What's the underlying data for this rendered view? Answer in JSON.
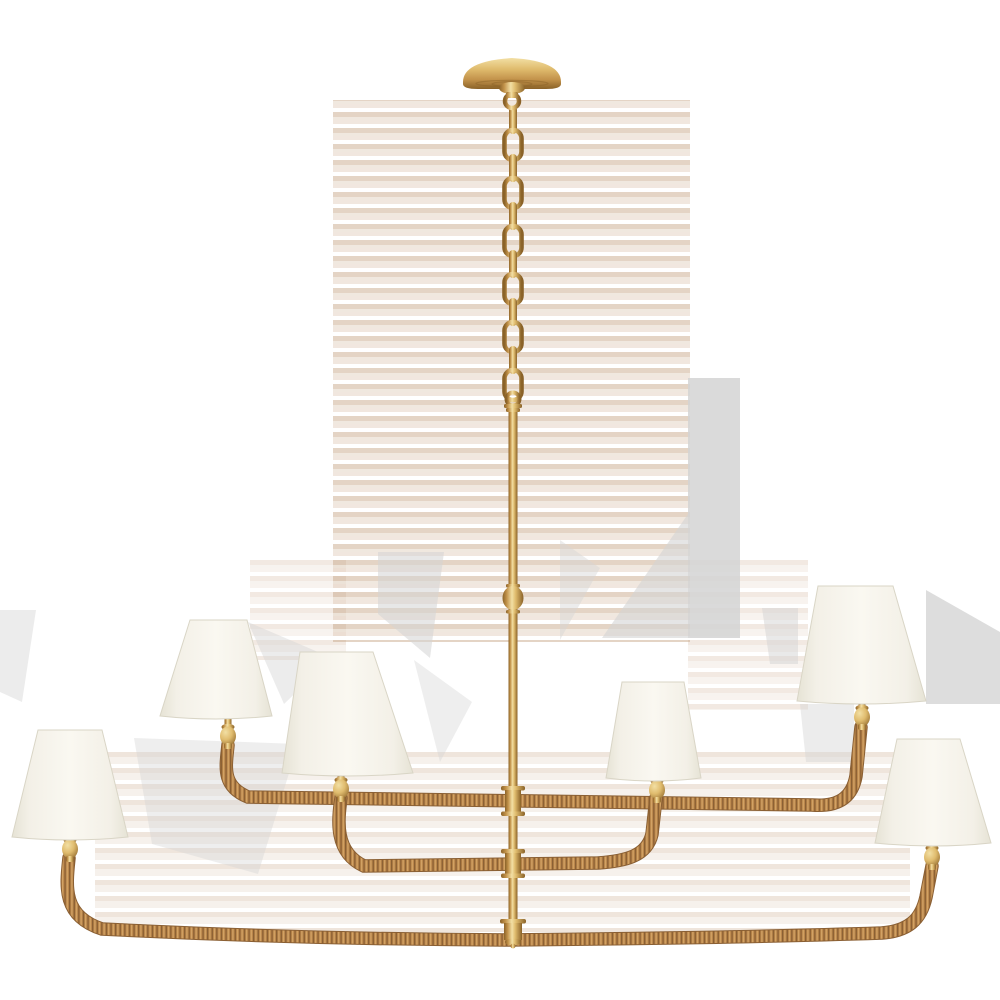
{
  "meta": {
    "description": "Product photograph of a six-light three-tier linear chandelier: hand-rubbed antique brass ceiling canopy, chain and center stem, rattan-wrapped curved arms, six tapered white linen shades, on a plain white background",
    "background_color": "#ffffff",
    "light_count": 6
  },
  "colors": {
    "brass_highlight": "#f2dfa4",
    "brass_light": "#e0bc6e",
    "brass_mid": "#c2924a",
    "brass_dark": "#8a6228",
    "rattan_light": "#d8a96b",
    "rattan_mid": "#b9854a",
    "rattan_dark": "#8a5f33",
    "shade_light": "#faf8f1",
    "shade_mid": "#f3f0e7",
    "shade_dark": "#e6e3d5",
    "shade_edge": "#d9d5c6",
    "artifact_gray": "#d4d4d4",
    "artifact_tan1": "#c9a88b",
    "artifact_tan2": "#e0d0bf"
  },
  "parts": {
    "canopy": {
      "d": "M463,82 Q463,61 512,58 Q561,61 561,82 L561,84 Q561,89 546,89 L478,89 Q463,89 463,84 Z"
    },
    "chain": {
      "x": 513,
      "start": 106,
      "count": 12,
      "step": 24,
      "front_w": 17,
      "front_h": 30,
      "edge_w": 8,
      "edge_h": 28
    },
    "stem": {
      "x": 513,
      "top": 412,
      "bottom": 942,
      "width": 9,
      "knob_y": 598
    },
    "arms": [
      {
        "name": "upper-tier-arm",
        "path": "M228,745 C226,766 221,786 248,797 L812,805 C838,807 852,798 856,776 L861,727"
      },
      {
        "name": "middle-tier-arm",
        "path": "M341,798 C338,820 334,852 364,866 L598,863 C626,861 647,856 652,834 L656,798"
      },
      {
        "name": "lower-tier-arm",
        "path": "M69,858 C66,886 62,916 102,929 Q300,939 505,940 Q730,938 882,933 C908,931 921,920 926,897 L932,866"
      }
    ],
    "shades": [
      {
        "name": "shade-far-left",
        "t1": [
          38,
          730
        ],
        "t2": [
          102,
          730
        ],
        "b2": [
          128,
          837
        ],
        "b1": [
          12,
          837
        ]
      },
      {
        "name": "shade-left-upper",
        "t1": [
          190,
          620
        ],
        "t2": [
          247,
          620
        ],
        "b2": [
          272,
          716
        ],
        "b1": [
          160,
          716
        ]
      },
      {
        "name": "shade-center-left",
        "t1": [
          300,
          652
        ],
        "t2": [
          373,
          652
        ],
        "b2": [
          413,
          773
        ],
        "b1": [
          282,
          773
        ]
      },
      {
        "name": "shade-center-right",
        "t1": [
          622,
          682
        ],
        "t2": [
          684,
          682
        ],
        "b2": [
          701,
          778
        ],
        "b1": [
          606,
          778
        ]
      },
      {
        "name": "shade-right-upper",
        "t1": [
          818,
          586
        ],
        "t2": [
          893,
          586
        ],
        "b2": [
          926,
          701
        ],
        "b1": [
          797,
          701
        ]
      },
      {
        "name": "shade-far-right",
        "t1": [
          897,
          739
        ],
        "t2": [
          960,
          739
        ],
        "b2": [
          991,
          843
        ],
        "b1": [
          875,
          843
        ]
      }
    ],
    "sockets": [
      {
        "cx": 70,
        "cy": 849
      },
      {
        "cx": 228,
        "cy": 736
      },
      {
        "cx": 341,
        "cy": 789
      },
      {
        "cx": 657,
        "cy": 790
      },
      {
        "cx": 862,
        "cy": 717
      },
      {
        "cx": 932,
        "cy": 857
      }
    ],
    "artifacts": {
      "stripe_blocks": [
        {
          "x": 333,
          "y": 100,
          "w": 357,
          "h": 542,
          "o": 0.5
        },
        {
          "x": 95,
          "y": 750,
          "w": 815,
          "h": 182,
          "o": 0.3
        },
        {
          "x": 688,
          "y": 560,
          "w": 120,
          "h": 150,
          "o": 0.25
        },
        {
          "x": 250,
          "y": 560,
          "w": 96,
          "h": 100,
          "o": 0.25
        }
      ],
      "gray_polys": [
        {
          "points": "688,378 740,378 740,638 688,638",
          "o": 0.85
        },
        {
          "points": "602,638 688,514 688,638",
          "o": 0.6
        },
        {
          "points": "560,540 600,568 560,640",
          "o": 0.45
        },
        {
          "points": "378,552 444,552 430,658 378,614",
          "o": 0.55
        },
        {
          "points": "248,622 332,658 284,704",
          "o": 0.45
        },
        {
          "points": "134,738 298,744 258,874 152,844",
          "o": 0.4
        },
        {
          "points": "926,590 1000,632 1000,704 926,704",
          "o": 0.8
        },
        {
          "points": "762,608 798,608 798,664 770,664",
          "o": 0.5
        },
        {
          "points": "800,704 854,704 854,762 806,762",
          "o": 0.45
        },
        {
          "points": "0,610 36,610 22,702 0,692",
          "o": 0.45
        },
        {
          "points": "414,660 472,702 440,762",
          "o": 0.4
        }
      ]
    }
  }
}
